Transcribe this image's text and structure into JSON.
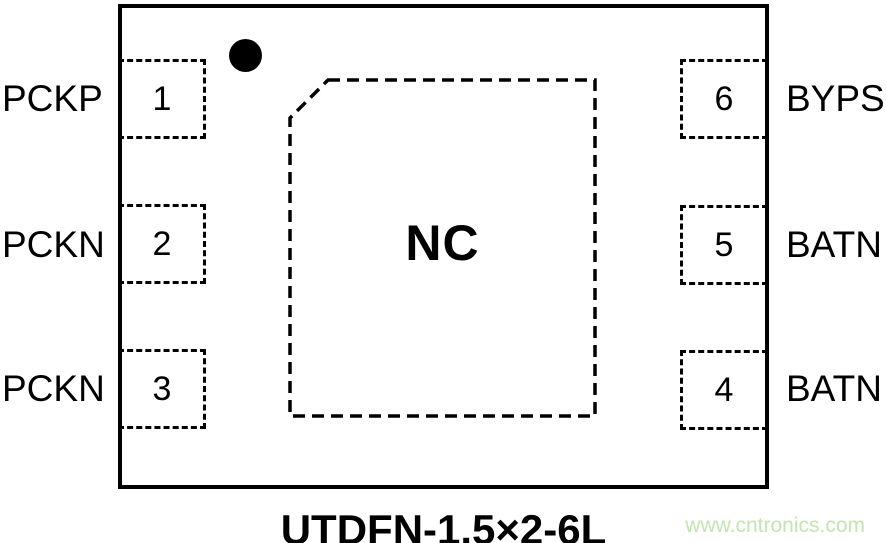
{
  "diagram": {
    "package_title": "UTDFN-1.5×2-6L",
    "center_pad_label": "NC",
    "watermark_text": "www.cntronics.com",
    "colors": {
      "line": "#000000",
      "background": "#ffffff",
      "watermark": "#c2e5b1"
    },
    "left_pins": [
      {
        "number": "1",
        "label": "PCKP"
      },
      {
        "number": "2",
        "label": "PCKN"
      },
      {
        "number": "3",
        "label": "PCKN"
      }
    ],
    "right_pins": [
      {
        "number": "6",
        "label": "BYPS"
      },
      {
        "number": "5",
        "label": "BATN"
      },
      {
        "number": "4",
        "label": "BATN"
      }
    ]
  }
}
